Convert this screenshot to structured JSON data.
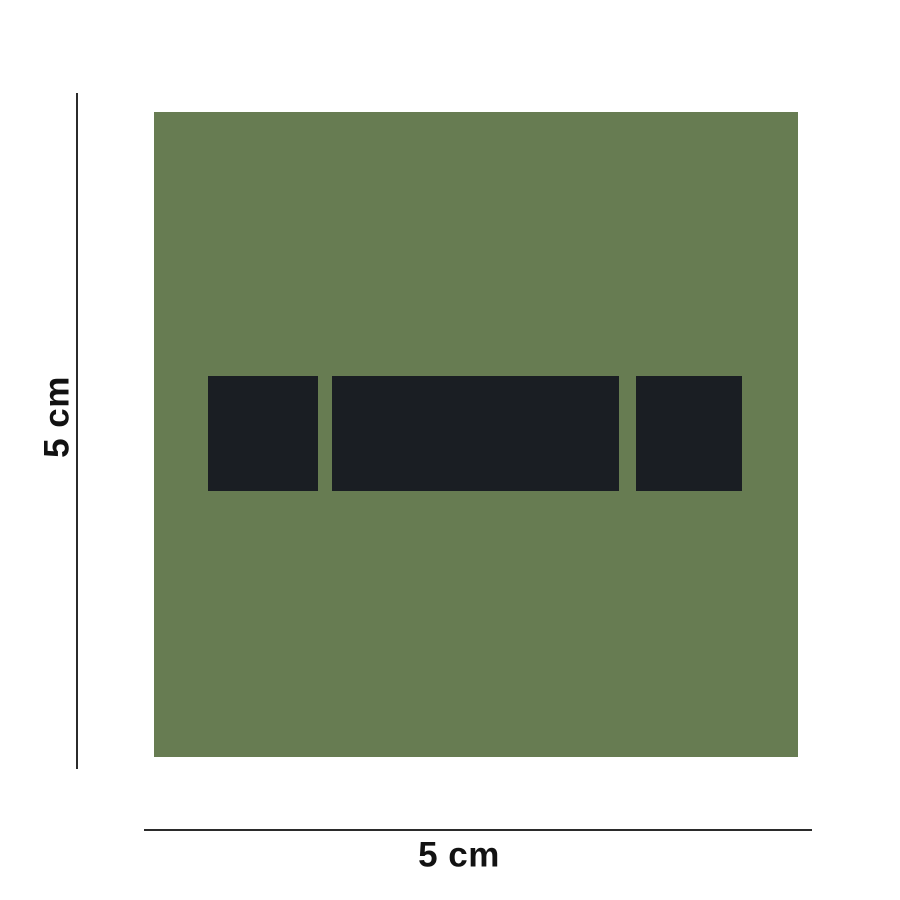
{
  "product": {
    "description": "olive green square patch with dark rank insignia",
    "insignia_shapes": [
      "small-square",
      "wide-bar",
      "small-square"
    ]
  },
  "dimensions": {
    "height_label": "5 cm",
    "width_label": "5 cm"
  },
  "theme": {
    "page-bg": "#ffffff",
    "patch-green": "#677C52",
    "insignia-dark": "#1A1E23",
    "line-color": "#2B2B2B",
    "text-color": "#121212"
  }
}
